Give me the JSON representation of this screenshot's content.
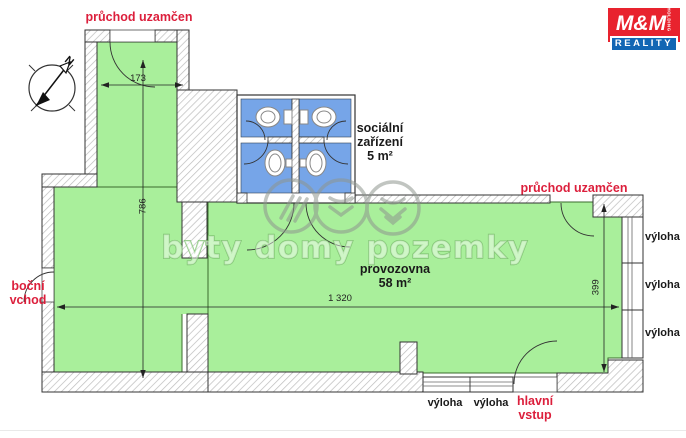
{
  "colors": {
    "green": "#a9ef9b",
    "blue": "#76a5e8",
    "red": "#dc1f3c",
    "black": "#1a1a1a",
    "hatchLine": "#bcbcbc",
    "wallStroke": "#333333",
    "logoRed": "#e8232e",
    "logoBlue": "#1266b4",
    "wmStroke": "#7cc06e"
  },
  "logo": {
    "mm": "M&M",
    "holding": "HOLDING",
    "reality": "REALITY"
  },
  "labels": {
    "passage_top": "průchod uzamčen",
    "passage_right": "průchod uzamčen",
    "side_entrance_line1": "boční",
    "side_entrance_line2": "vchod",
    "main_entrance_line1": "hlavní",
    "main_entrance_line2": "vstup",
    "window": "výloha"
  },
  "rooms": {
    "sanitary": {
      "name_line1": "sociální",
      "name_line2": "zařízení",
      "area": "5 m²"
    },
    "premises": {
      "name": "provozovna",
      "area": "58 m²"
    }
  },
  "dimensions": {
    "corridor_width": "173",
    "corridor_length": "786",
    "premises_length": "1 320",
    "premises_depth": "399"
  },
  "watermark": {
    "text": "byty domy pozemky"
  },
  "compass": {
    "north": "N"
  }
}
